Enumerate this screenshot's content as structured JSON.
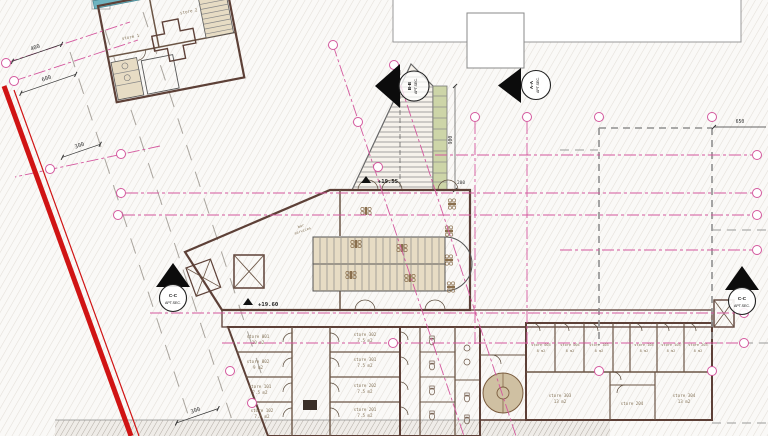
{
  "drawing": {
    "rooms": {
      "store1": {
        "name": "store 1"
      },
      "store2": {
        "name": "store 2"
      },
      "bar": {
        "line1": "bar",
        "line2": "services"
      },
      "s001": {
        "name": "store 001",
        "area": "10 m2"
      },
      "s002": {
        "name": "store 002",
        "area": "9 m2"
      },
      "s101": {
        "name": "store 101",
        "area": "7.5 m2"
      },
      "s102": {
        "name": "store 102",
        "area": "7.5 m2"
      },
      "s302": {
        "name": "store 302",
        "area": "7.5 m2"
      },
      "s301": {
        "name": "store 301",
        "area": "7.5 m2"
      },
      "s202": {
        "name": "store 202",
        "area": "7.5 m2"
      },
      "s201": {
        "name": "store 201",
        "area": "7.5 m2"
      },
      "s003": {
        "name": "store 003",
        "area": "8 m2"
      },
      "s004": {
        "name": "store 004",
        "area": "8 m2"
      },
      "s103": {
        "name": "store 103",
        "area": "8 m2"
      },
      "s104": {
        "name": "store 104",
        "area": "8 m2"
      },
      "s105": {
        "name": "store 105",
        "area": "8 m2"
      },
      "s203": {
        "name": "store 203",
        "area": "8 m2"
      },
      "s303": {
        "name": "store 303",
        "area": "13 m2"
      },
      "s204": {
        "name": "store 204"
      },
      "s304": {
        "name": "store 304",
        "area": "13 m2"
      }
    },
    "levels": {
      "main": "+19.60",
      "entrance": "+19.55"
    },
    "dims": {
      "d400": "400",
      "d600": "600",
      "d300_top": "300",
      "d300_bottom": "300",
      "d650": "650",
      "d900": "900",
      "d200": "200"
    },
    "markers": {
      "aa": {
        "name": "A-A",
        "label": "APT.SEC."
      },
      "bb": {
        "name": "B-B",
        "label": "APT.SEC."
      },
      "cc_left": {
        "name": "C-C",
        "label": "APT.SEC."
      },
      "cc_right": {
        "name": "C-C",
        "label": "APT.SEC."
      }
    },
    "colors": {
      "boundary": "#d01414",
      "grid": "#d4589e",
      "wall": "#5d4037",
      "room_fill": "#d9c9ab"
    }
  }
}
